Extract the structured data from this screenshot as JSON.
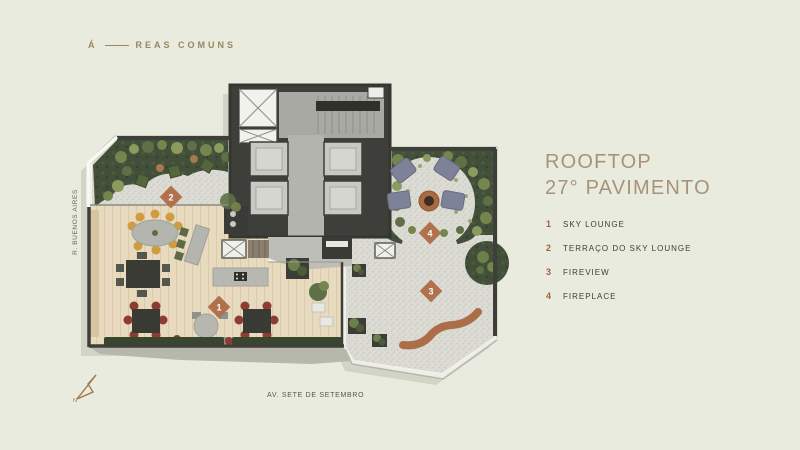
{
  "header": {
    "prefix": "Á",
    "rest": "REAS COMUNS"
  },
  "title": {
    "line1": "ROOFTOP",
    "line2": "27° PAVIMENTO"
  },
  "legend": {
    "items": [
      {
        "number": "1",
        "label": "SKY LOUNGE"
      },
      {
        "number": "2",
        "label": "TERRAÇO DO SKY LOUNGE"
      },
      {
        "number": "3",
        "label": "FIREVIEW"
      },
      {
        "number": "4",
        "label": "FIREPLACE"
      }
    ]
  },
  "plan": {
    "markers": [
      "1",
      "2",
      "3",
      "4"
    ]
  },
  "streets": {
    "left": "R. BUENOS AIRES",
    "bottom": "AV. SETE DE SETEMBRO"
  },
  "compass": {
    "label": "N"
  },
  "colors": {
    "background": "#e8ebde",
    "accent_title": "#a8927a",
    "legend_number": "#a45f3e",
    "marker": "#b0714c",
    "vegetation": "#424f39",
    "wood_floor": "#e7dabe",
    "core_wall": "#3e3f3a"
  }
}
